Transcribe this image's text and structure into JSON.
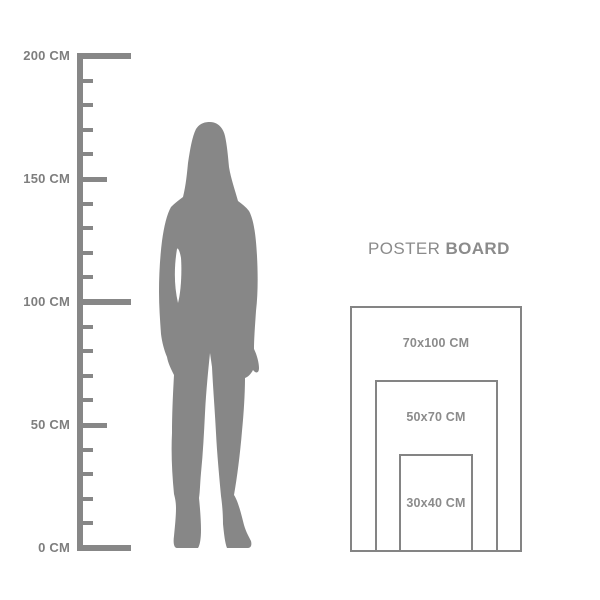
{
  "colors": {
    "background": "#ffffff",
    "silhouette_gray": "#878787",
    "ruler_gray": "#878787",
    "ruler_text_gray": "#7e7e7e",
    "title_gray": "#8b8b8b",
    "rect_border_gray": "#848484",
    "rect_label_gray": "#8b8b8b"
  },
  "ruler": {
    "unit": "CM",
    "min_cm": 0,
    "max_cm": 200,
    "minor_step_cm": 10,
    "labeled_ticks": [
      {
        "value_cm": 200,
        "label": "200 CM",
        "size": "long"
      },
      {
        "value_cm": 150,
        "label": "150 CM",
        "size": "medium"
      },
      {
        "value_cm": 100,
        "label": "100 CM",
        "size": "long"
      },
      {
        "value_cm": 50,
        "label": "50 CM",
        "size": "medium"
      },
      {
        "value_cm": 0,
        "label": "0 CM",
        "size": "long"
      }
    ]
  },
  "figure": {
    "icon": "woman-silhouette",
    "approx_height_cm": 173
  },
  "poster": {
    "title_regular": "POSTER",
    "title_bold": "BOARD",
    "sizes": [
      {
        "label": "70x100 CM",
        "width_cm": 70,
        "height_cm": 100
      },
      {
        "label": "50x70 CM",
        "width_cm": 50,
        "height_cm": 70
      },
      {
        "label": "30x40 CM",
        "width_cm": 30,
        "height_cm": 40
      }
    ]
  }
}
